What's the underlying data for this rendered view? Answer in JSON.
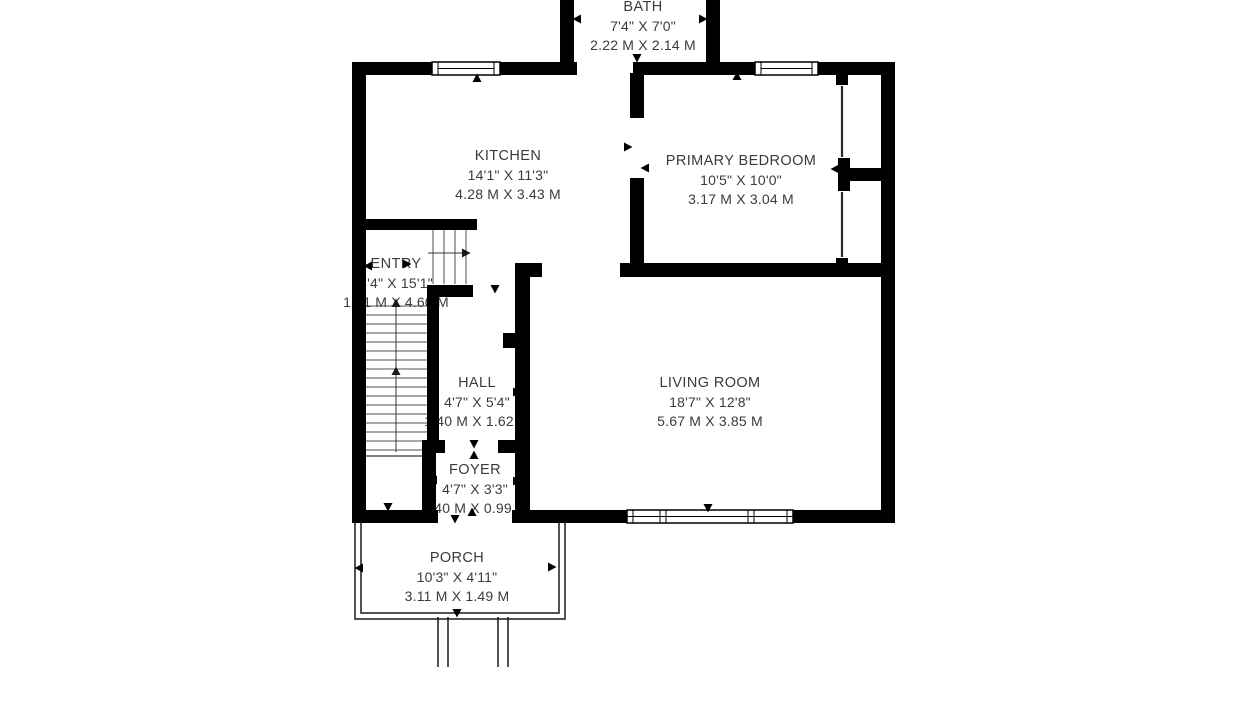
{
  "plan": {
    "background_color": "#ffffff",
    "wall_color": "#000000",
    "text_color": "#3b3b3b",
    "rooms": [
      {
        "id": "bath",
        "name": "BATH",
        "imperial": "7'4\" X 7'0\"",
        "metric": "2.22 M X 2.14 M"
      },
      {
        "id": "kitchen",
        "name": "KITCHEN",
        "imperial": "14'1\" X 11'3\"",
        "metric": "4.28 M X 3.43 M"
      },
      {
        "id": "primary-bedroom",
        "name": "PRIMARY BEDROOM",
        "imperial": "10'5\" X 10'0\"",
        "metric": "3.17 M X 3.04 M"
      },
      {
        "id": "entry",
        "name": "ENTRY",
        "imperial": "3'4\" X 15'1\"",
        "metric": "1.01 M X 4.60 M"
      },
      {
        "id": "hall",
        "name": "HALL",
        "imperial": "4'7\" X 5'4\"",
        "metric": "1.40 M X 1.62 M"
      },
      {
        "id": "living-room",
        "name": "LIVING ROOM",
        "imperial": "18'7\" X 12'8\"",
        "metric": "5.67 M X 3.85 M"
      },
      {
        "id": "foyer",
        "name": "FOYER",
        "imperial": "4'7\" X 3'3\"",
        "metric": "1.40 M X 0.99 M"
      },
      {
        "id": "porch",
        "name": "PORCH",
        "imperial": "10'3\" X 4'11\"",
        "metric": "3.11 M X 1.49 M"
      }
    ]
  }
}
